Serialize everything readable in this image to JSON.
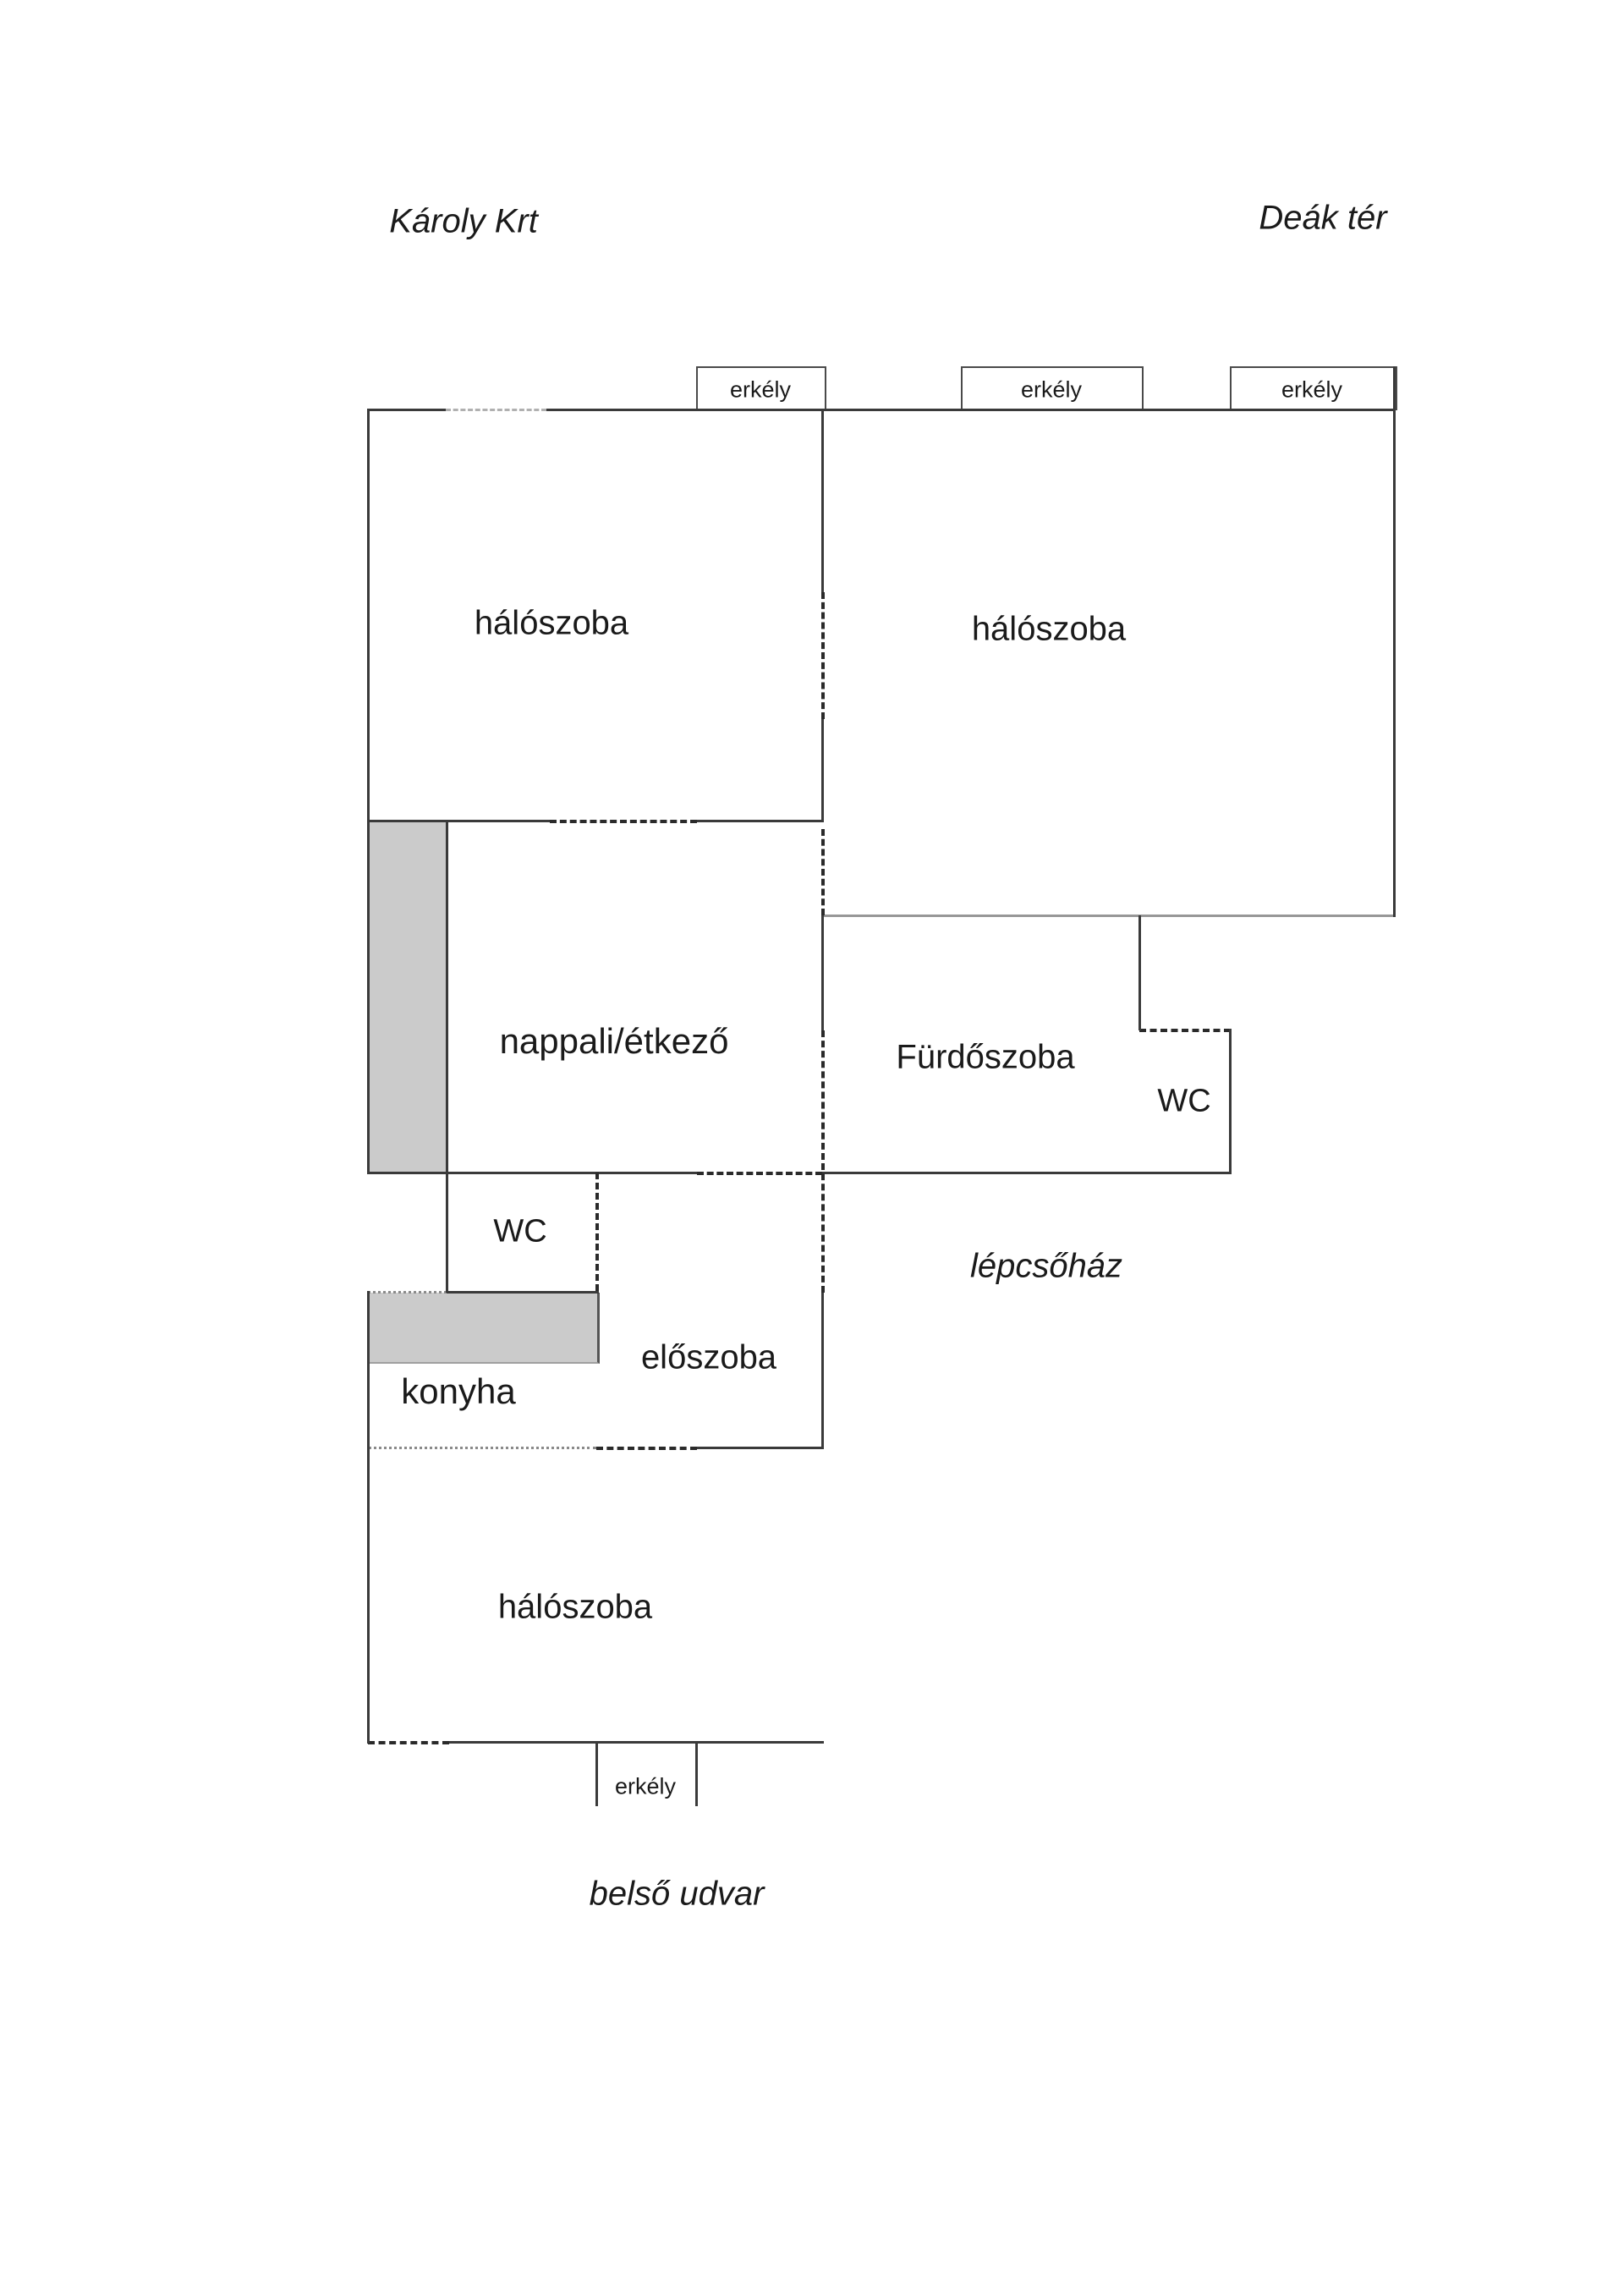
{
  "street_labels": {
    "top_left": "Károly Krt",
    "top_right": "Deák tér",
    "stairwell": "lépcsőház",
    "bottom": "belső udvar"
  },
  "rooms": {
    "bedroom_left": "hálószoba",
    "bedroom_right": "hálószoba",
    "bedroom_bottom": "hálószoba",
    "living_dining": "nappali/étkező",
    "bathroom": "Fürdőszoba",
    "wc_bathroom": "WC",
    "wc_hall": "WC",
    "hallway": "előszoba",
    "kitchen": "konyha"
  },
  "balconies": {
    "top_1": "erkély",
    "top_2": "erkély",
    "top_3": "erkély",
    "bottom": "erkély"
  },
  "colors": {
    "wall": "#3a3a3a",
    "wall_light": "#979797",
    "gray_fill": "#cbcbcb",
    "text": "#1a1a1a"
  }
}
